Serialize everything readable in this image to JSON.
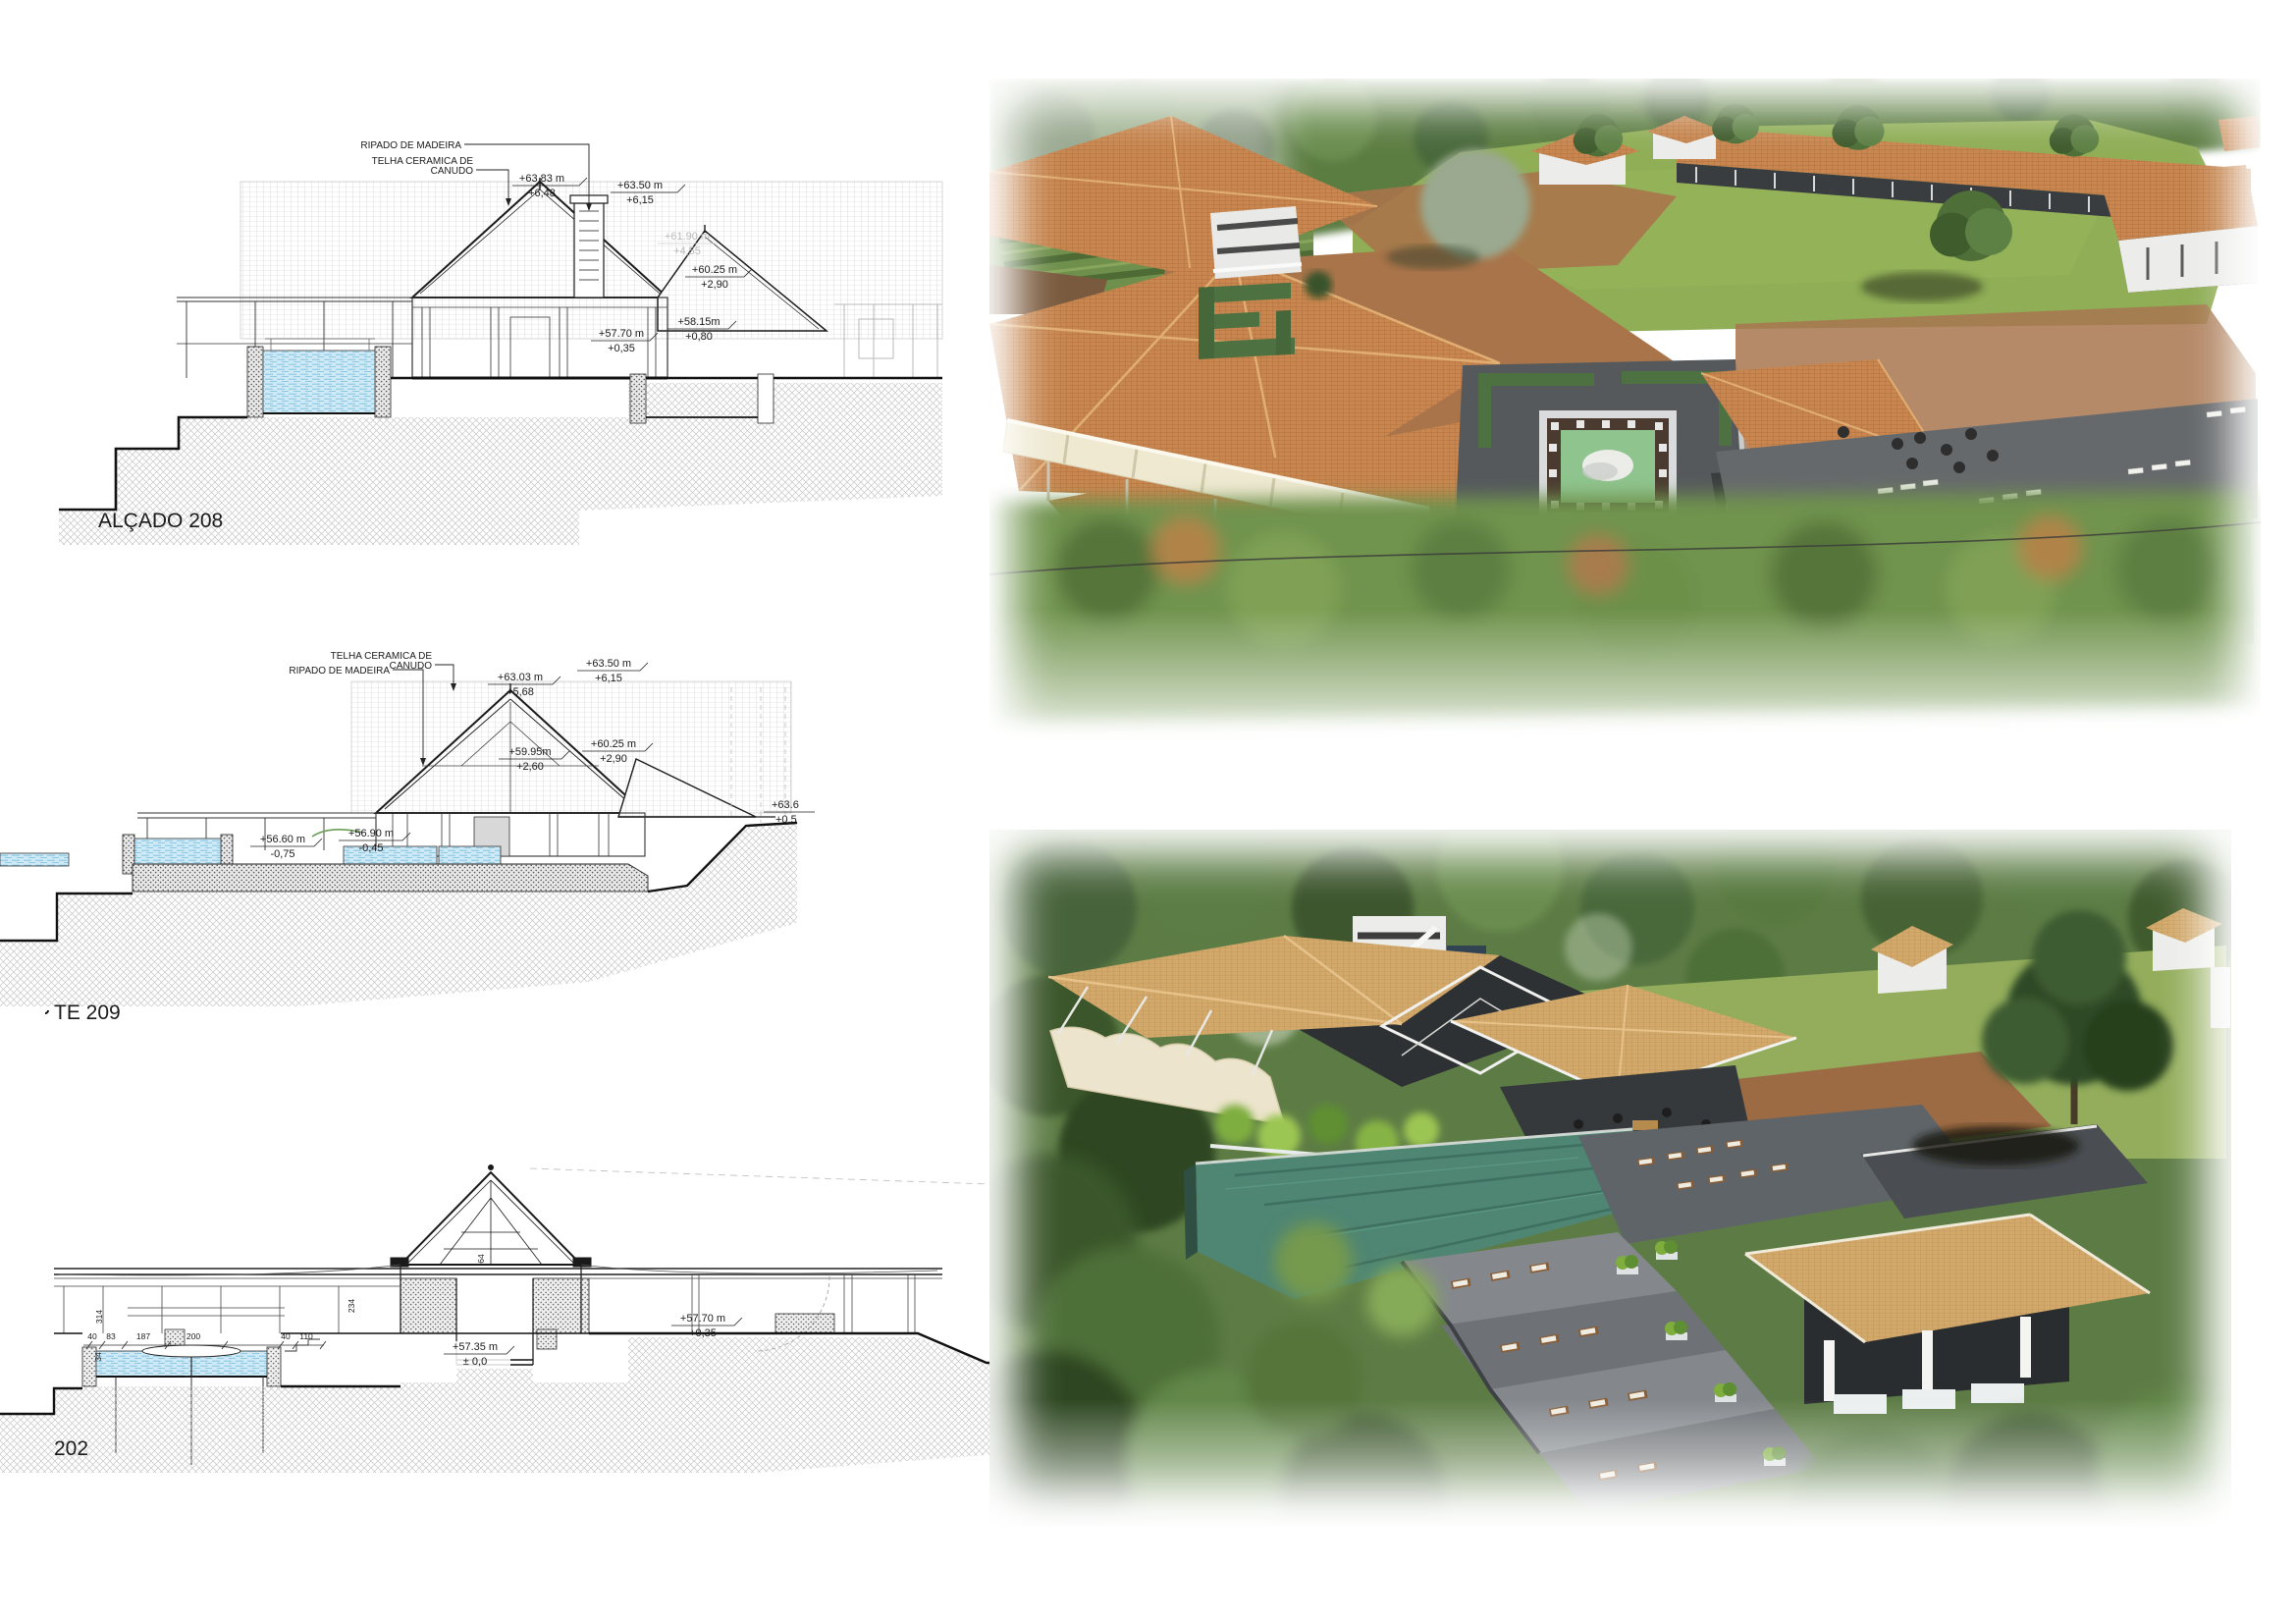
{
  "sheet": {
    "type": "architecture-presentation-sheet"
  },
  "d1": {
    "label": "ALÇADO 208",
    "ann": {
      "ripado": "RIPADO DE MADEIRA",
      "telha1": "TELHA CERAMICA DE",
      "telha2": "CANUDO"
    },
    "lv": {
      "a1": "+63.83 m",
      "a2": "+6,48",
      "b1": "+63.50 m",
      "b2": "+6,15",
      "f1": "+61.90 m",
      "f2": "+4,55",
      "c1": "+60.25 m",
      "c2": "+2,90",
      "d1": "+58.15m",
      "d2": "+0,80",
      "e1": "+57.70 m",
      "e2": "+0,35"
    }
  },
  "d2": {
    "label": "TE 209",
    "ann": {
      "telha1": "TELHA CERAMICA DE",
      "telha2": "CANUDO",
      "ripado": "RIPADO DE MADEIRA"
    },
    "lv": {
      "a1": "+63.03 m",
      "a2": "+5,68",
      "b1": "+63.50 m",
      "b2": "+6,15",
      "c1": "+59.95m",
      "c2": "+2,60",
      "d1": "+60.25 m",
      "d2": "+2,90",
      "e1": "+56.60 m",
      "e2": "-0,75",
      "g1": "+56.90 m",
      "g2": "-0,45",
      "h1": "+63.6",
      "h2": "+0,5"
    }
  },
  "d3": {
    "label": "202",
    "lv": {
      "a1": "+57.35 m",
      "a2": "± 0,0",
      "b1": "+57.70 m",
      "b2": "+0,35"
    },
    "dims": {
      "v314": "314",
      "h40a": "40",
      "h83": "83",
      "h187": "187",
      "h200": "200",
      "h40b": "40",
      "h110": "110",
      "v234": "234",
      "v64": "64",
      "v34": "34"
    }
  },
  "colors": {
    "line": "#1a1a1a",
    "hatch": "#c6c6c6",
    "section_water": "#cfeaf7",
    "roof_terracotta": "#c9874f",
    "roof_tan": "#d2a96b",
    "lawn": "#8fae56",
    "dirt": "#a9744a",
    "plaza_gray": "#55595c",
    "pool_teal": "#5ec3a9",
    "pool_dark": "#4e8573",
    "canopy_cream": "#efe9d2",
    "forest": "#4e7038",
    "hedge": "#4d7140"
  }
}
